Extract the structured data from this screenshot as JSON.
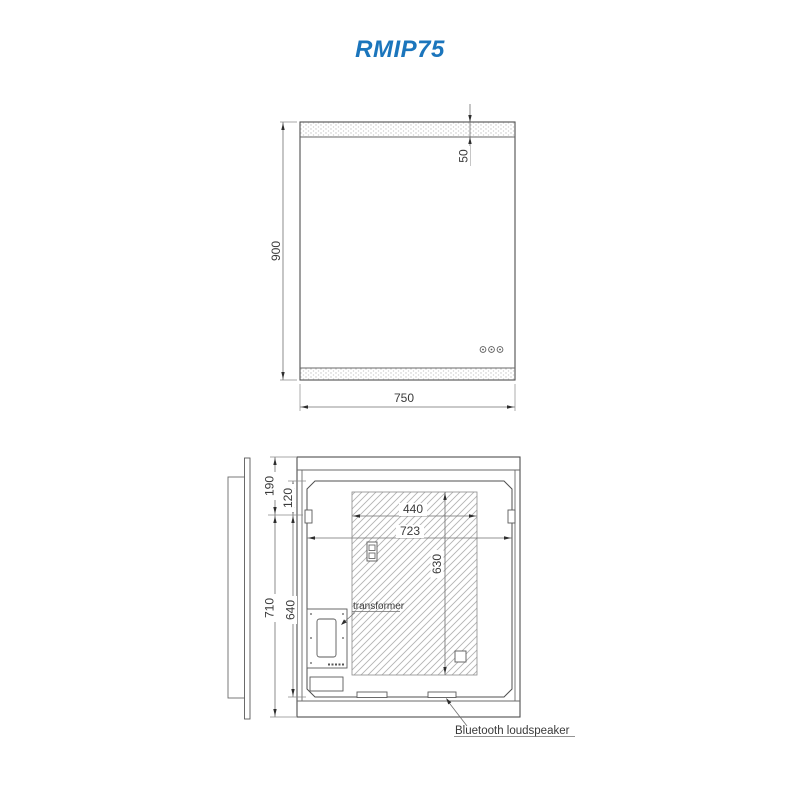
{
  "header": {
    "title": "RMIP75",
    "title_color": "#1b75bc"
  },
  "front_view": {
    "dim_height": "900",
    "dim_width": "750",
    "dim_led_strip": "50",
    "touch_buttons": [
      "touch-button-1",
      "touch-button-2",
      "touch-button-3"
    ]
  },
  "rear_view": {
    "dim_top_to_hanger": "190",
    "dim_frame_to_hanger": "120",
    "dim_hanger_to_bottom": "710",
    "dim_frame_inner_height": "640",
    "dim_backplate_width": "440",
    "dim_cavity_width": "723",
    "dim_backplate_height": "630",
    "transformer_label": "transformer",
    "loudspeaker_label": "Bluetooth loudspeaker"
  },
  "colors": {
    "line": "#4f4f4f",
    "hatch": "#b3b3b3",
    "text": "#3a3a3a"
  }
}
